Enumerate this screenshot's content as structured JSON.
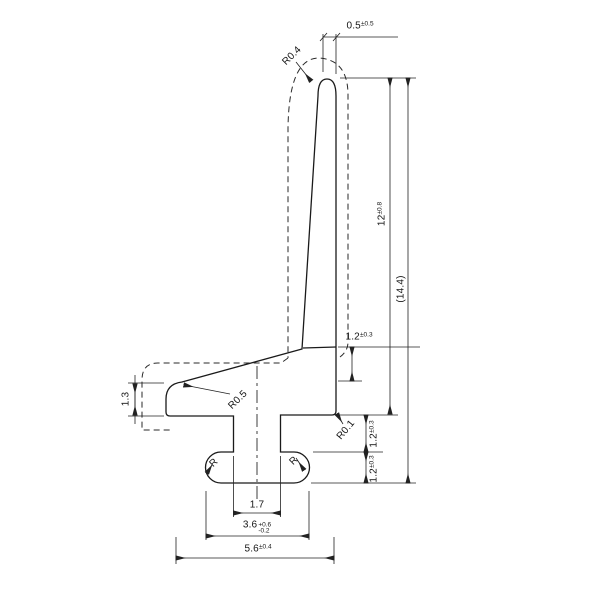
{
  "drawing": {
    "type": "technical-cross-section",
    "background": "#ffffff",
    "line_color": "#1a1a1a",
    "dimensions": {
      "tip_width": {
        "value": "0.5",
        "tolerance": "±0.5"
      },
      "tip_radius": {
        "label": "R0.4"
      },
      "lip_height": {
        "value": "12",
        "tolerance": "±0.8"
      },
      "overall_height": {
        "value": "(14.4)"
      },
      "arm_thickness": {
        "value": "1.2",
        "tolerance": "±0.3"
      },
      "junction_radius": {
        "label": "R0.1"
      },
      "clearance_height": {
        "value": "1.2",
        "tolerance": "±0.3"
      },
      "foot_height": {
        "value": "1.2",
        "tolerance": "±0.3"
      },
      "arm_end_thickness": {
        "value": "1.3"
      },
      "arm_corner_radius": {
        "label": "R0.5"
      },
      "foot_radius_left": {
        "label": "R"
      },
      "foot_radius_right": {
        "label": "R"
      },
      "neck_width": {
        "value": "1.7"
      },
      "foot_width": {
        "value": "3.6",
        "tolerance_plus": "+0.6",
        "tolerance_minus": "-0.2"
      },
      "overall_width": {
        "value": "5.6",
        "tolerance": "±0.4"
      }
    }
  }
}
